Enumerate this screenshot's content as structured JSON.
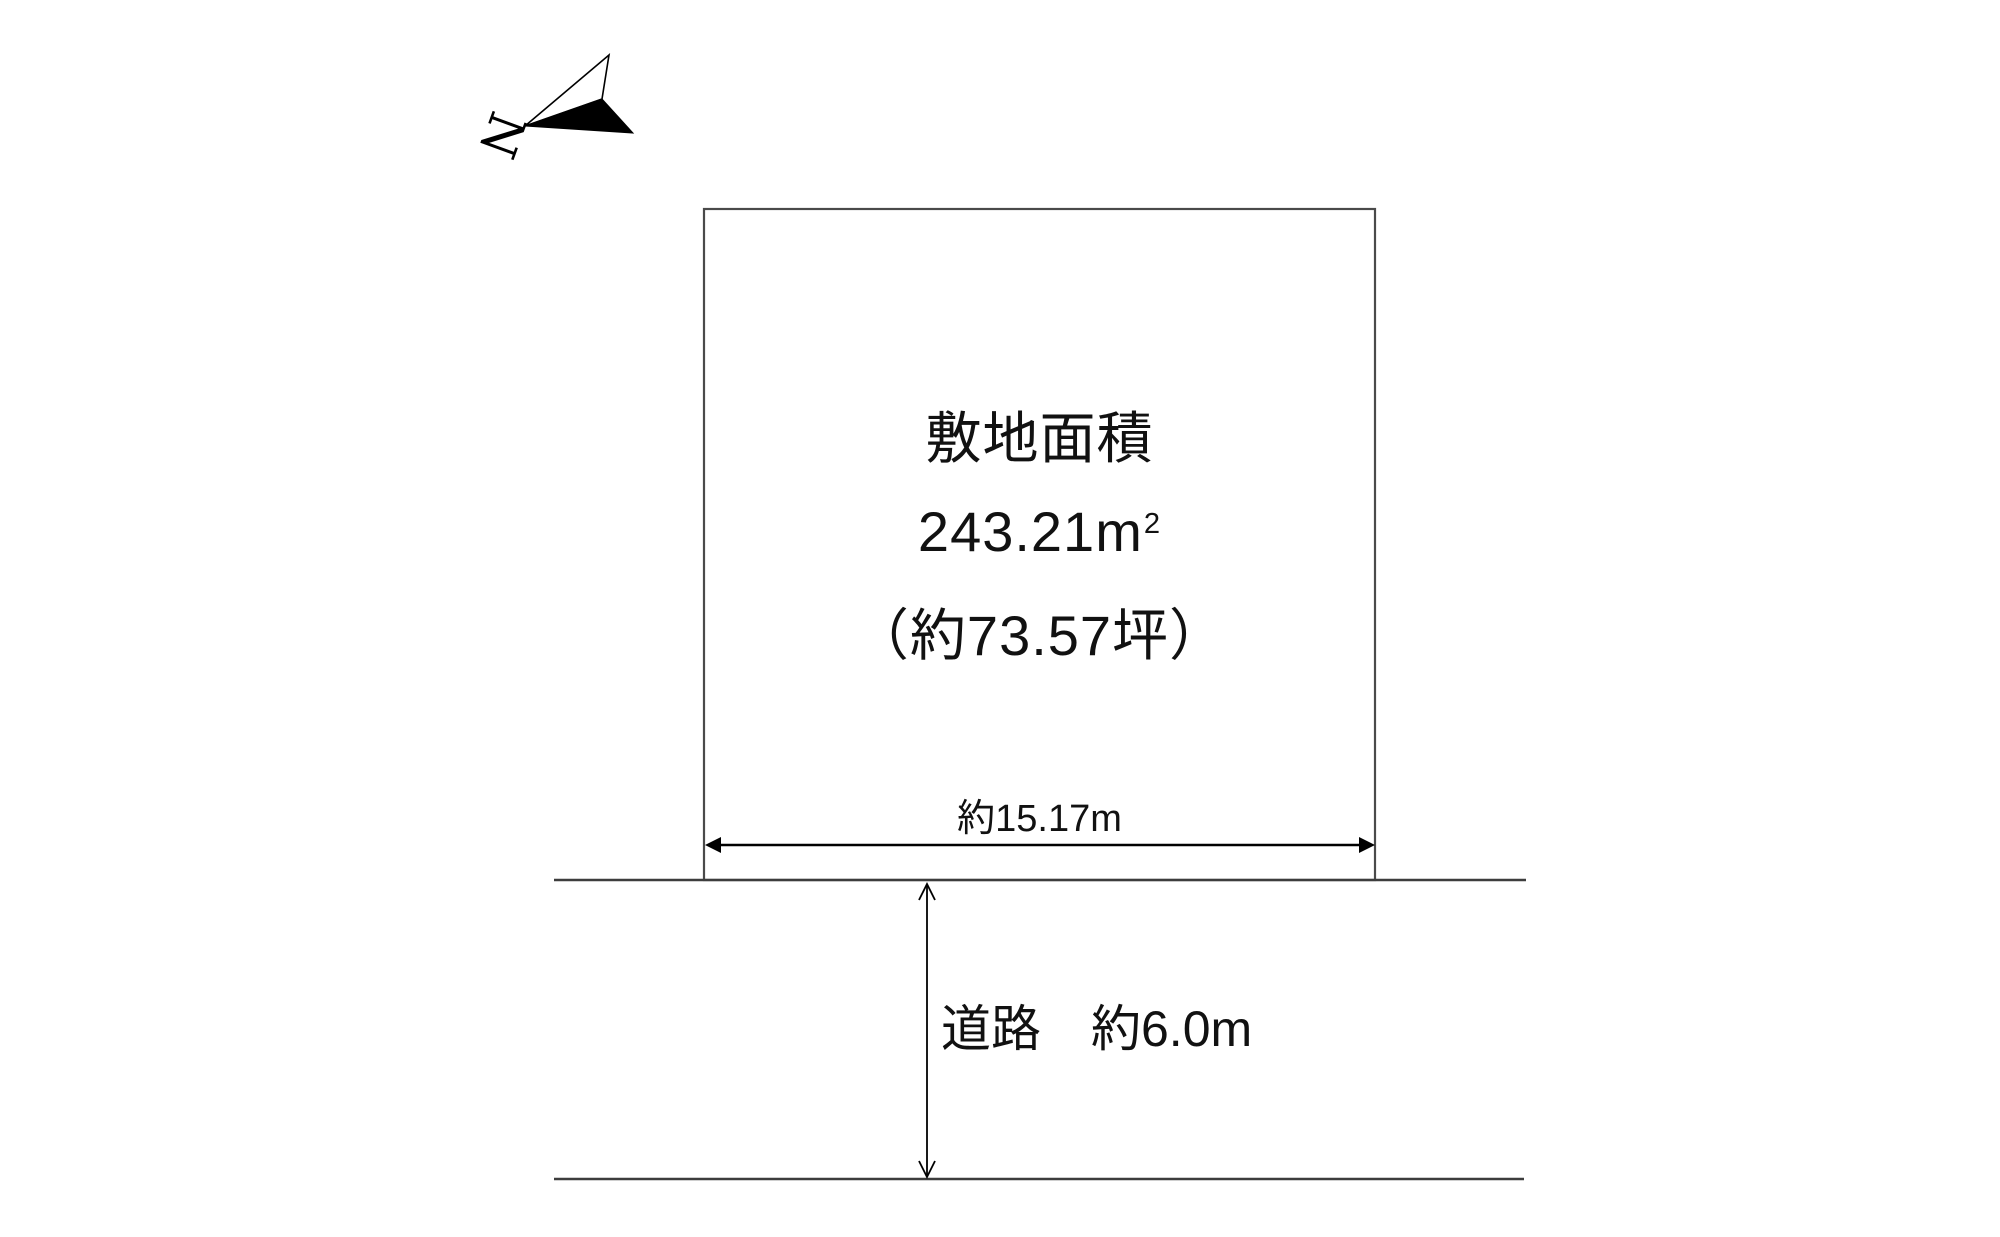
{
  "compass": {
    "north_label": "N"
  },
  "plot": {
    "title": "敷地面積",
    "area_value": "243.21",
    "area_unit_base": "m",
    "area_unit_exponent": "2",
    "tsubo_label": "（約73.57坪）",
    "width_label": "約15.17m"
  },
  "road": {
    "label": "道路　約6.0m"
  },
  "colors": {
    "boundary_line": "#4a4a4a",
    "road_line": "#3d3d3d",
    "dimension_line": "#000000",
    "text": "#111111"
  }
}
